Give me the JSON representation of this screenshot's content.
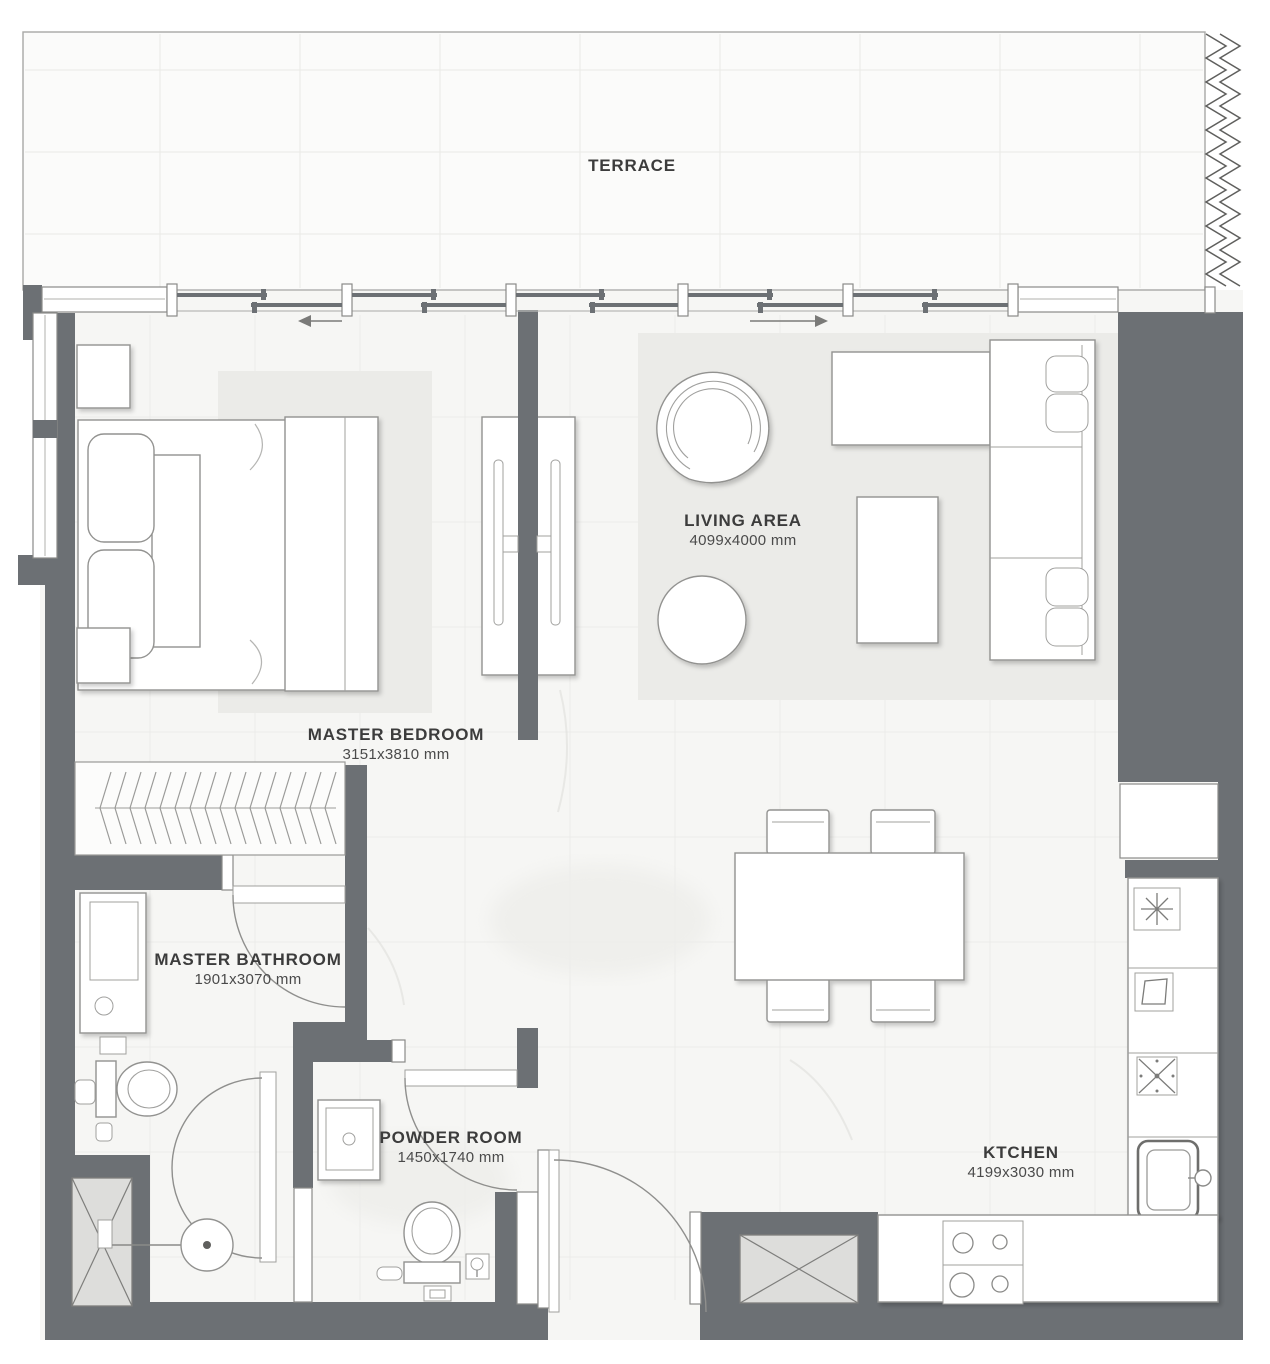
{
  "floor_plan": {
    "rooms": [
      {
        "id": "terrace",
        "label": "TERRACE"
      },
      {
        "id": "living-area",
        "label": "LIVING AREA",
        "dimensions": "4099x4000 mm"
      },
      {
        "id": "master-bedroom",
        "label": "MASTER BEDROOM",
        "dimensions": "3151x3810 mm"
      },
      {
        "id": "master-bathroom",
        "label": "MASTER BATHROOM",
        "dimensions": "1901x3070 mm"
      },
      {
        "id": "powder-room",
        "label": "POWDER ROOM",
        "dimensions": "1450x1740 mm"
      },
      {
        "id": "kitchen",
        "label": "KTCHEN",
        "dimensions": "4199x3030 mm"
      }
    ],
    "colors": {
      "wall": "#6c7074",
      "floor": "#f6f6f4",
      "terrace": "#fbfbfa",
      "rug": "#ebebe8",
      "outline": "#929290",
      "label_text": "#3c3c3c"
    }
  }
}
